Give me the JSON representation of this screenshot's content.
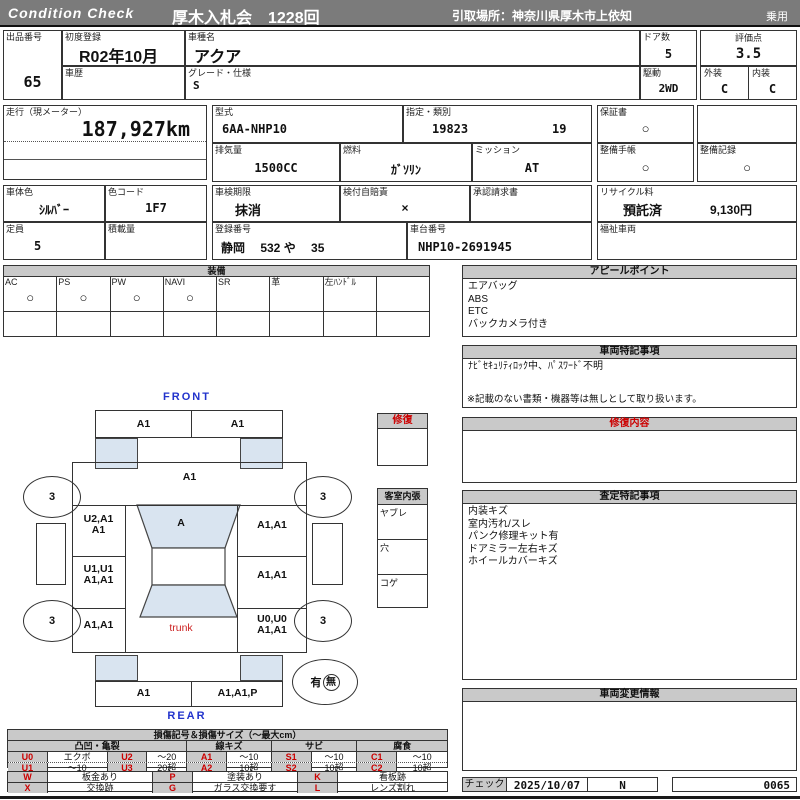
{
  "header": {
    "brand": "Condition  Check",
    "auction": "厚木入札会　1228回",
    "pickup": "引取場所：神奈川県厚木市上依知",
    "category": "乗用"
  },
  "info": {
    "lot_label": "出品番号",
    "lot_value": "65",
    "first_reg_label": "初度登録",
    "first_reg_value": "R02年10月",
    "model_label": "車種名",
    "model_value": "アクア",
    "history_label": "車歴",
    "history_value": "",
    "grade_label": "グレード・仕様",
    "grade_value": "S",
    "doors_label": "ドア数",
    "doors_value": "5",
    "drive_label": "駆動",
    "drive_value": "2WD",
    "score_label": "評価点",
    "score_value": "3.5",
    "exterior_label": "外装",
    "exterior_value": "C",
    "interior_label": "内装",
    "interior_value": "C"
  },
  "specs": {
    "mileage_label": "走行（現メーター）",
    "mileage_value": "187,927km",
    "type_label": "型式",
    "type_value": "6AA-NHP10",
    "class_label": "指定・類別",
    "class_value1": "19823",
    "class_value2": "19",
    "warranty_label": "保証書",
    "warranty_value": "○",
    "displacement_label": "排気量",
    "displacement_value": "1500CC",
    "fuel_label": "燃料",
    "fuel_value": "ｶﾞｿﾘﾝ",
    "mission_label": "ミッション",
    "mission_value": "AT",
    "maintenance_book_label": "整備手帳",
    "maintenance_book_value": "○",
    "maintenance_record_label": "整備記録",
    "maintenance_record_value": "○"
  },
  "registration": {
    "color_label": "車体色",
    "color_value": "ｼﾙﾊﾞｰ",
    "color_code_label": "色コード",
    "color_code_value": "1F7",
    "inspection_label": "車検期限",
    "inspection_value": "抹消",
    "insurance_label": "検付自賠責",
    "insurance_value": "×",
    "approval_label": "承認請求書",
    "recycle_label": "リサイクル料",
    "recycle_status": "預託済",
    "recycle_fee": "9,130円",
    "capacity_label": "定員",
    "capacity_value": "5",
    "load_label": "積載量",
    "plate_label": "登録番号",
    "plate_value": "静岡　 532 や　 35",
    "vin_label": "車台番号",
    "vin_value": "NHP10-2691945",
    "welfare_label": "福祉車両"
  },
  "equipment": {
    "title": "装備",
    "items": [
      {
        "label": "AC",
        "value": "○"
      },
      {
        "label": "PS",
        "value": "○"
      },
      {
        "label": "PW",
        "value": "○"
      },
      {
        "label": "NAVI",
        "value": "○"
      },
      {
        "label": "SR",
        "value": ""
      },
      {
        "label": "革",
        "value": ""
      },
      {
        "label": "左ﾊﾝﾄﾞﾙ",
        "value": ""
      },
      {
        "label": "",
        "value": ""
      }
    ]
  },
  "appeal": {
    "title": "アピールポイント",
    "lines": [
      "エアバッグ",
      "ABS",
      "ETC",
      "バックカメラ付き"
    ]
  },
  "vehicle_notes": {
    "title": "車両特記事項",
    "lines": [
      "ﾅﾋﾞｾｷｭﾘﾃｨﾛｯｸ中、ﾊﾟｽﾜｰﾄﾞ不明"
    ],
    "footnote": "※記載のない書類・機器等は無しとして取り扱います。"
  },
  "repair": {
    "title": "修復内容",
    "lines": []
  },
  "assessment": {
    "title": "査定特記事項",
    "lines": [
      "内装キズ",
      "室内汚れ/スレ",
      "パンク修理キット有",
      "ドアミラー左右キズ",
      "ホイールカバーキズ"
    ]
  },
  "change_info": {
    "title": "車両変更情報",
    "lines": []
  },
  "check": {
    "label": "チェック",
    "date": "2025/10/07",
    "inspector": "N",
    "number": "0065"
  },
  "diagram": {
    "front_label": "FRONT",
    "rear_label": "REAR",
    "trunk_label": "trunk",
    "repair_box_label": "修復",
    "interior_box_label": "客室内張",
    "interior_rows": [
      "ヤブレ",
      "穴",
      "コゲ"
    ],
    "front_bumper_left": "A1",
    "front_bumper_right": "A1",
    "hood": "A1",
    "windshield": "A",
    "left_front": "U2,A1\nA1",
    "right_front": "A1,A1",
    "left_door": "U1,U1\nA1,A1",
    "right_door": "A1,A1",
    "left_rear": "A1,A1",
    "right_rear": "U0,U0\nA1,A1",
    "rear_bumper_left": "A1",
    "rear_bumper_right": "A1,A1,P",
    "tire_front_left": "3",
    "tire_front_right": "3",
    "tire_rear_left": "3",
    "tire_rear_right": "3",
    "spare_yes": "有",
    "spare_no": "無"
  },
  "legend": {
    "title": "損傷記号＆損傷サイズ（～最大cm）",
    "groups": [
      "凸凹・亀裂",
      "線キズ",
      "サビ",
      "腐食"
    ],
    "damage": [
      {
        "code": "U0",
        "desc": "エクボ"
      },
      {
        "code": "U1",
        "desc": "～10"
      },
      {
        "code": "U2",
        "desc": "～20"
      },
      {
        "code": "U3",
        "desc": "20超"
      },
      {
        "code": "A1",
        "desc": "～10"
      },
      {
        "code": "A2",
        "desc": "10超"
      },
      {
        "code": "S1",
        "desc": "～10"
      },
      {
        "code": "S2",
        "desc": "10超"
      },
      {
        "code": "C1",
        "desc": "～10"
      },
      {
        "code": "C2",
        "desc": "10超"
      }
    ],
    "marks": [
      {
        "code": "W",
        "desc": "板金あり"
      },
      {
        "code": "X",
        "desc": "交換跡"
      },
      {
        "code": "P",
        "desc": "塗装あり"
      },
      {
        "code": "G",
        "desc": "ガラス交換要す"
      },
      {
        "code": "K",
        "desc": "看板跡"
      },
      {
        "code": "L",
        "desc": "レンズ割れ"
      }
    ],
    "colors": {
      "code_red": "#cc0000",
      "header_gray": "#c9c9c9",
      "glass_blue": "#d9e4f0"
    }
  }
}
